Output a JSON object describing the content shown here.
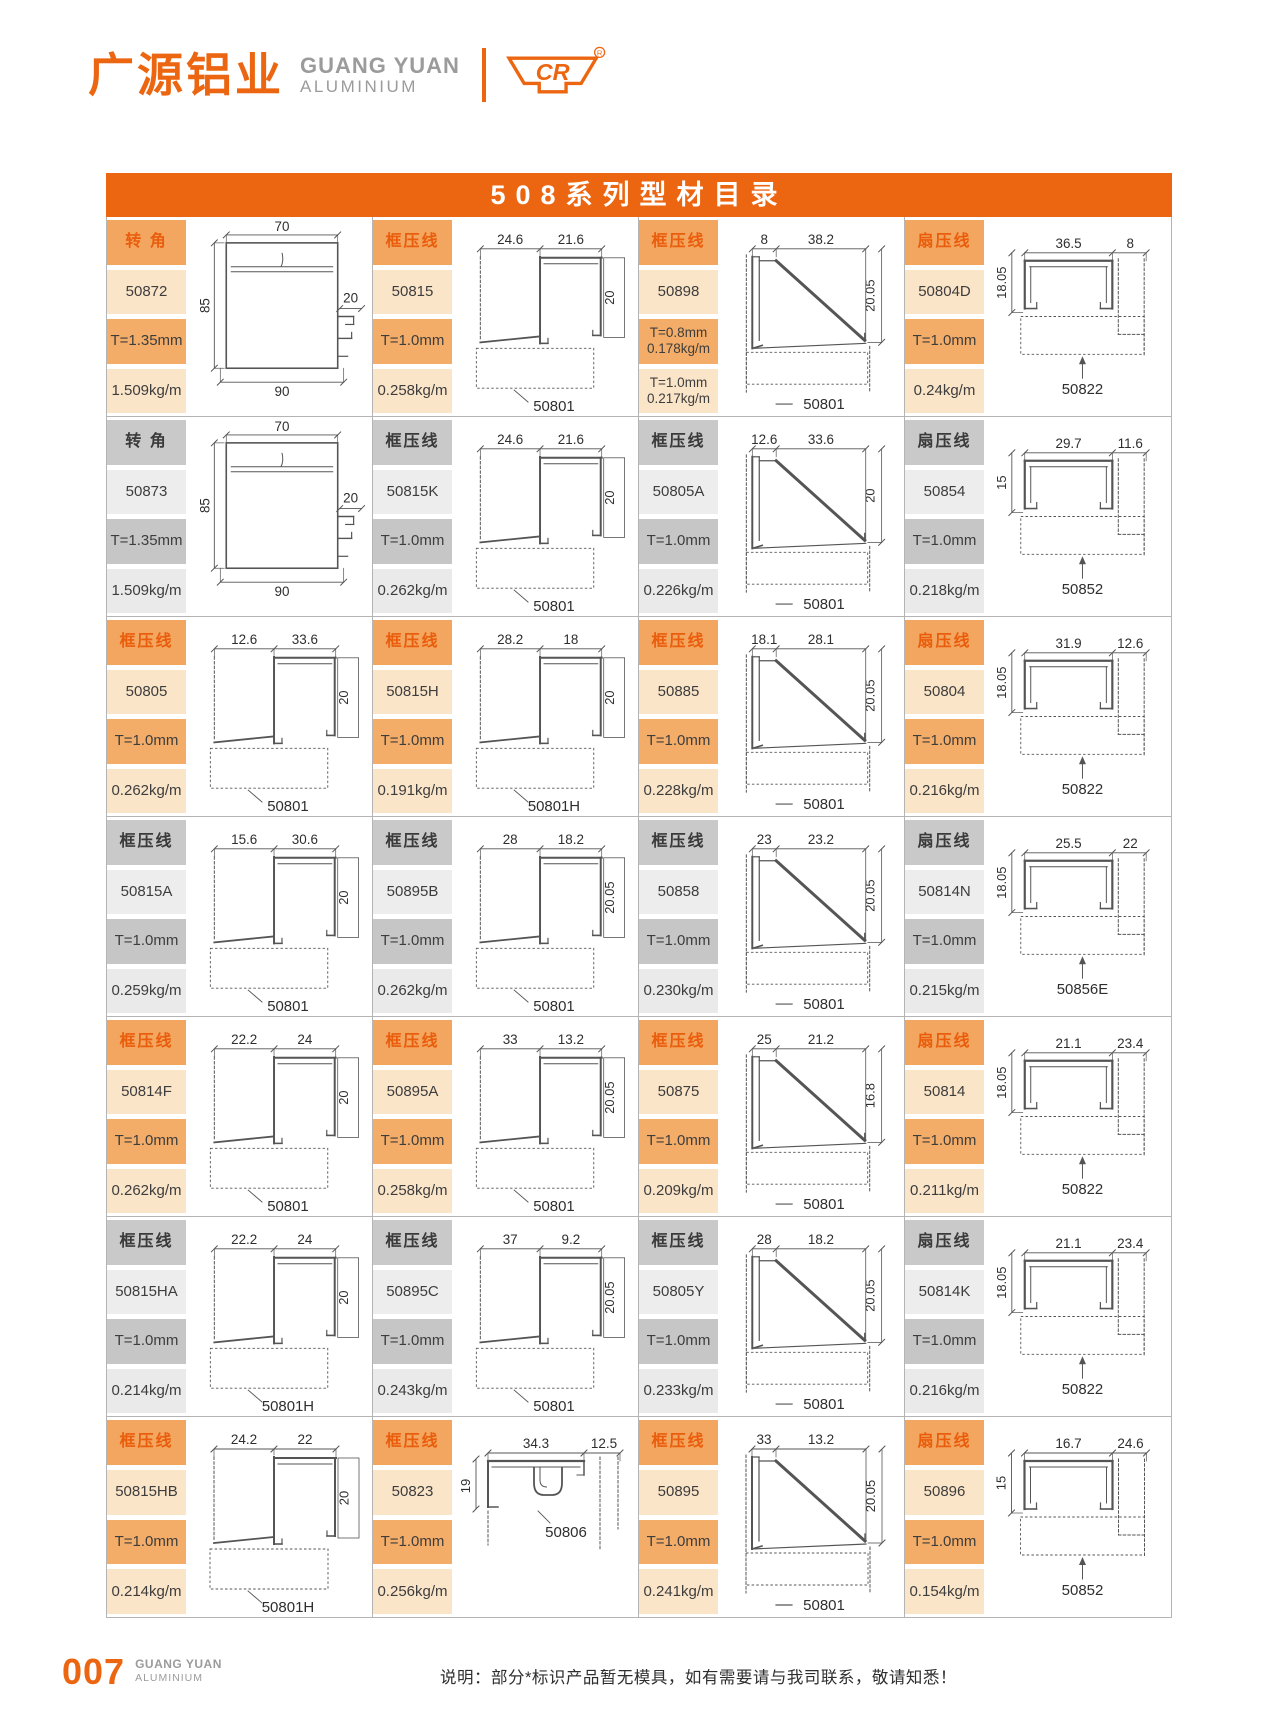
{
  "brand": {
    "logo_cn": "广源铝业",
    "logo_en_line1": "GUANG YUAN",
    "logo_en_line2": "ALUMINIUM",
    "cr_mark": "CR",
    "registered": "®"
  },
  "title": "508系列型材目录",
  "footer": {
    "page_number": "007",
    "brand_line1": "GUANG YUAN",
    "brand_line2": "ALUMINIUM",
    "note": "说明：部分*标识产品暂无模具，如有需要请与我司联系，敬请知悉！"
  },
  "colors": {
    "accent": "#EC6611",
    "orange_header_bg": "#F3A660",
    "orange_header_text": "#E95D0C",
    "orange_light_bg": "#FBE5C9",
    "orange_mid_bg": "#F3AD68",
    "gray_header_bg": "#C9C9C9",
    "gray_light_bg": "#EDEDED",
    "gray_mid_bg": "#C6C6C6",
    "grid_line": "#B4B4B4",
    "logo_gray": "#9B9B9B"
  },
  "cells": [
    {
      "category": "转 角",
      "code": "50872",
      "specs": [
        [
          "T=1.35mm"
        ],
        [
          "1.509kg/m"
        ]
      ],
      "theme": "orange",
      "drawing": {
        "type": "corner",
        "top": "70",
        "left": "85",
        "right": "20",
        "bottom": "90",
        "label": ""
      }
    },
    {
      "category": "框压线",
      "code": "50815",
      "specs": [
        [
          "T=1.0mm"
        ],
        [
          "0.258kg/m"
        ]
      ],
      "theme": "orange",
      "drawing": {
        "type": "step",
        "top1": "24.6",
        "top2": "21.6",
        "side": "20",
        "label": "50801"
      }
    },
    {
      "category": "框压线",
      "code": "50898",
      "specs": [
        [
          "T=0.8mm",
          "0.178kg/m"
        ],
        [
          "T=1.0mm",
          "0.217kg/m"
        ]
      ],
      "theme": "orange",
      "drawing": {
        "type": "diag",
        "top1": "8",
        "top2": "38.2",
        "side": "20.05",
        "label": "50801"
      }
    },
    {
      "category": "扇压线",
      "code": "50804D",
      "specs": [
        [
          "T=1.0mm"
        ],
        [
          "0.24kg/m"
        ]
      ],
      "theme": "orange",
      "drawing": {
        "type": "sash",
        "top1": "36.5",
        "top2": "8",
        "side": "18.05",
        "label": "50822"
      }
    },
    {
      "category": "转 角",
      "code": "50873",
      "specs": [
        [
          "T=1.35mm"
        ],
        [
          "1.509kg/m"
        ]
      ],
      "theme": "gray",
      "drawing": {
        "type": "corner",
        "top": "70",
        "left": "85",
        "right": "20",
        "bottom": "90",
        "label": ""
      }
    },
    {
      "category": "框压线",
      "code": "50815K",
      "specs": [
        [
          "T=1.0mm"
        ],
        [
          "0.262kg/m"
        ]
      ],
      "theme": "gray",
      "drawing": {
        "type": "step",
        "top1": "24.6",
        "top2": "21.6",
        "side": "20",
        "label": "50801"
      }
    },
    {
      "category": "框压线",
      "code": "50805A",
      "specs": [
        [
          "T=1.0mm"
        ],
        [
          "0.226kg/m"
        ]
      ],
      "theme": "gray",
      "drawing": {
        "type": "diag",
        "top1": "12.6",
        "top2": "33.6",
        "side": "20",
        "label": "50801"
      }
    },
    {
      "category": "扇压线",
      "code": "50854",
      "specs": [
        [
          "T=1.0mm"
        ],
        [
          "0.218kg/m"
        ]
      ],
      "theme": "gray",
      "drawing": {
        "type": "sash",
        "top1": "29.7",
        "top2": "11.6",
        "side": "15",
        "label": "50852"
      }
    },
    {
      "category": "框压线",
      "code": "50805",
      "specs": [
        [
          "T=1.0mm"
        ],
        [
          "0.262kg/m"
        ]
      ],
      "theme": "orange",
      "drawing": {
        "type": "step",
        "top1": "12.6",
        "top2": "33.6",
        "side": "20",
        "label": "50801"
      }
    },
    {
      "category": "框压线",
      "code": "50815H",
      "specs": [
        [
          "T=1.0mm"
        ],
        [
          "0.191kg/m"
        ]
      ],
      "theme": "orange",
      "drawing": {
        "type": "step",
        "top1": "28.2",
        "top2": "18",
        "side": "20",
        "label": "50801H"
      }
    },
    {
      "category": "框压线",
      "code": "50885",
      "specs": [
        [
          "T=1.0mm"
        ],
        [
          "0.228kg/m"
        ]
      ],
      "theme": "orange",
      "drawing": {
        "type": "diag",
        "top1": "18.1",
        "top2": "28.1",
        "side": "20.05",
        "label": "50801"
      }
    },
    {
      "category": "扇压线",
      "code": "50804",
      "specs": [
        [
          "T=1.0mm"
        ],
        [
          "0.216kg/m"
        ]
      ],
      "theme": "orange",
      "drawing": {
        "type": "sash",
        "top1": "31.9",
        "top2": "12.6",
        "side": "18.05",
        "label": "50822"
      }
    },
    {
      "category": "框压线",
      "code": "50815A",
      "specs": [
        [
          "T=1.0mm"
        ],
        [
          "0.259kg/m"
        ]
      ],
      "theme": "gray",
      "drawing": {
        "type": "step",
        "top1": "15.6",
        "top2": "30.6",
        "side": "20",
        "label": "50801"
      }
    },
    {
      "category": "框压线",
      "code": "50895B",
      "specs": [
        [
          "T=1.0mm"
        ],
        [
          "0.262kg/m"
        ]
      ],
      "theme": "gray",
      "drawing": {
        "type": "step",
        "top1": "28",
        "top2": "18.2",
        "side": "20.05",
        "label": "50801"
      }
    },
    {
      "category": "框压线",
      "code": "50858",
      "specs": [
        [
          "T=1.0mm"
        ],
        [
          "0.230kg/m"
        ]
      ],
      "theme": "gray",
      "drawing": {
        "type": "diag",
        "top1": "23",
        "top2": "23.2",
        "side": "20.05",
        "label": "50801"
      }
    },
    {
      "category": "扇压线",
      "code": "50814N",
      "specs": [
        [
          "T=1.0mm"
        ],
        [
          "0.215kg/m"
        ]
      ],
      "theme": "gray",
      "drawing": {
        "type": "sash",
        "top1": "25.5",
        "top2": "22",
        "side": "18.05",
        "label": "50856E"
      }
    },
    {
      "category": "框压线",
      "code": "50814F",
      "specs": [
        [
          "T=1.0mm"
        ],
        [
          "0.262kg/m"
        ]
      ],
      "theme": "orange",
      "drawing": {
        "type": "step",
        "top1": "22.2",
        "top2": "24",
        "side": "20",
        "label": "50801"
      }
    },
    {
      "category": "框压线",
      "code": "50895A",
      "specs": [
        [
          "T=1.0mm"
        ],
        [
          "0.258kg/m"
        ]
      ],
      "theme": "orange",
      "drawing": {
        "type": "step",
        "top1": "33",
        "top2": "13.2",
        "side": "20.05",
        "label": "50801"
      }
    },
    {
      "category": "框压线",
      "code": "50875",
      "specs": [
        [
          "T=1.0mm"
        ],
        [
          "0.209kg/m"
        ]
      ],
      "theme": "orange",
      "drawing": {
        "type": "diag",
        "top1": "25",
        "top2": "21.2",
        "side": "16.8",
        "label": "50801"
      }
    },
    {
      "category": "扇压线",
      "code": "50814",
      "specs": [
        [
          "T=1.0mm"
        ],
        [
          "0.211kg/m"
        ]
      ],
      "theme": "orange",
      "drawing": {
        "type": "sash",
        "top1": "21.1",
        "top2": "23.4",
        "side": "18.05",
        "label": "50822"
      }
    },
    {
      "category": "框压线",
      "code": "50815HA",
      "specs": [
        [
          "T=1.0mm"
        ],
        [
          "0.214kg/m"
        ]
      ],
      "theme": "gray",
      "drawing": {
        "type": "step",
        "top1": "22.2",
        "top2": "24",
        "side": "20",
        "label": "50801H"
      }
    },
    {
      "category": "框压线",
      "code": "50895C",
      "specs": [
        [
          "T=1.0mm"
        ],
        [
          "0.243kg/m"
        ]
      ],
      "theme": "gray",
      "drawing": {
        "type": "step",
        "top1": "37",
        "top2": "9.2",
        "side": "20.05",
        "label": "50801"
      }
    },
    {
      "category": "框压线",
      "code": "50805Y",
      "specs": [
        [
          "T=1.0mm"
        ],
        [
          "0.233kg/m"
        ]
      ],
      "theme": "gray",
      "drawing": {
        "type": "diag",
        "top1": "28",
        "top2": "18.2",
        "side": "20.05",
        "label": "50801"
      }
    },
    {
      "category": "扇压线",
      "code": "50814K",
      "specs": [
        [
          "T=1.0mm"
        ],
        [
          "0.216kg/m"
        ]
      ],
      "theme": "gray",
      "drawing": {
        "type": "sash",
        "top1": "21.1",
        "top2": "23.4",
        "side": "18.05",
        "label": "50822"
      }
    },
    {
      "category": "框压线",
      "code": "50815HB",
      "specs": [
        [
          "T=1.0mm"
        ],
        [
          "0.214kg/m"
        ]
      ],
      "theme": "orange",
      "drawing": {
        "type": "step",
        "top1": "24.2",
        "top2": "22",
        "side": "20",
        "label": "50801H"
      }
    },
    {
      "category": "框压线",
      "code": "50823",
      "specs": [
        [
          "T=1.0mm"
        ],
        [
          "0.256kg/m"
        ]
      ],
      "theme": "orange",
      "drawing": {
        "type": "hat",
        "top1": "34.3",
        "top2": "12.5",
        "side": "19",
        "label": "50806"
      }
    },
    {
      "category": "框压线",
      "code": "50895",
      "specs": [
        [
          "T=1.0mm"
        ],
        [
          "0.241kg/m"
        ]
      ],
      "theme": "orange",
      "drawing": {
        "type": "diag",
        "top1": "33",
        "top2": "13.2",
        "side": "20.05",
        "label": "50801"
      }
    },
    {
      "category": "扇压线",
      "code": "50896",
      "specs": [
        [
          "T=1.0mm"
        ],
        [
          "0.154kg/m"
        ]
      ],
      "theme": "orange",
      "drawing": {
        "type": "sash",
        "top1": "16.7",
        "top2": "24.6",
        "side": "15",
        "label": "50852"
      }
    }
  ]
}
